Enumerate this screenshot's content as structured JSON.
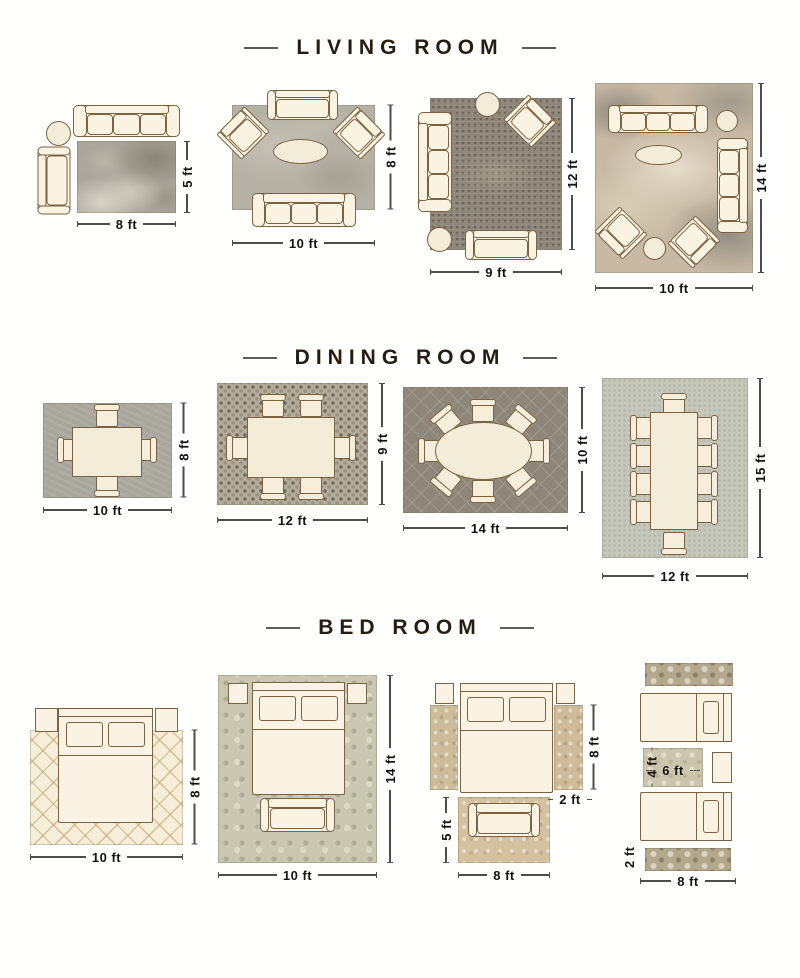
{
  "colors": {
    "background": "#fffffe",
    "title_text": "#271c12",
    "dimension_text": "#151310",
    "furniture_fill": "#faf3e2",
    "furniture_outline": "#7a6243"
  },
  "sections": [
    {
      "title": "LIVING ROOM",
      "layouts": [
        {
          "width_label": "8 ft",
          "height_label": "5 ft"
        },
        {
          "width_label": "10 ft",
          "height_label": "8 ft"
        },
        {
          "width_label": "9 ft",
          "height_label": "12 ft"
        },
        {
          "width_label": "10 ft",
          "height_label": "14 ft"
        }
      ]
    },
    {
      "title": "DINING ROOM",
      "layouts": [
        {
          "width_label": "10 ft",
          "height_label": "8 ft"
        },
        {
          "width_label": "12 ft",
          "height_label": "9 ft"
        },
        {
          "width_label": "14 ft",
          "height_label": "10 ft"
        },
        {
          "width_label": "12 ft",
          "height_label": "15 ft"
        }
      ]
    },
    {
      "title": "BED ROOM",
      "layouts": [
        {
          "width_label": "10 ft",
          "height_label": "8 ft"
        },
        {
          "width_label": "10 ft",
          "height_label": "14 ft"
        },
        {
          "runner_height_label": "8 ft",
          "runner_width_label": "2 ft",
          "foot_height_label": "5 ft",
          "foot_width_label": "8 ft"
        },
        {
          "center_height_label": "4 ft",
          "center_width_label": "6 ft",
          "runner_height_label": "2 ft",
          "runner_width_label": "8 ft"
        }
      ]
    }
  ]
}
